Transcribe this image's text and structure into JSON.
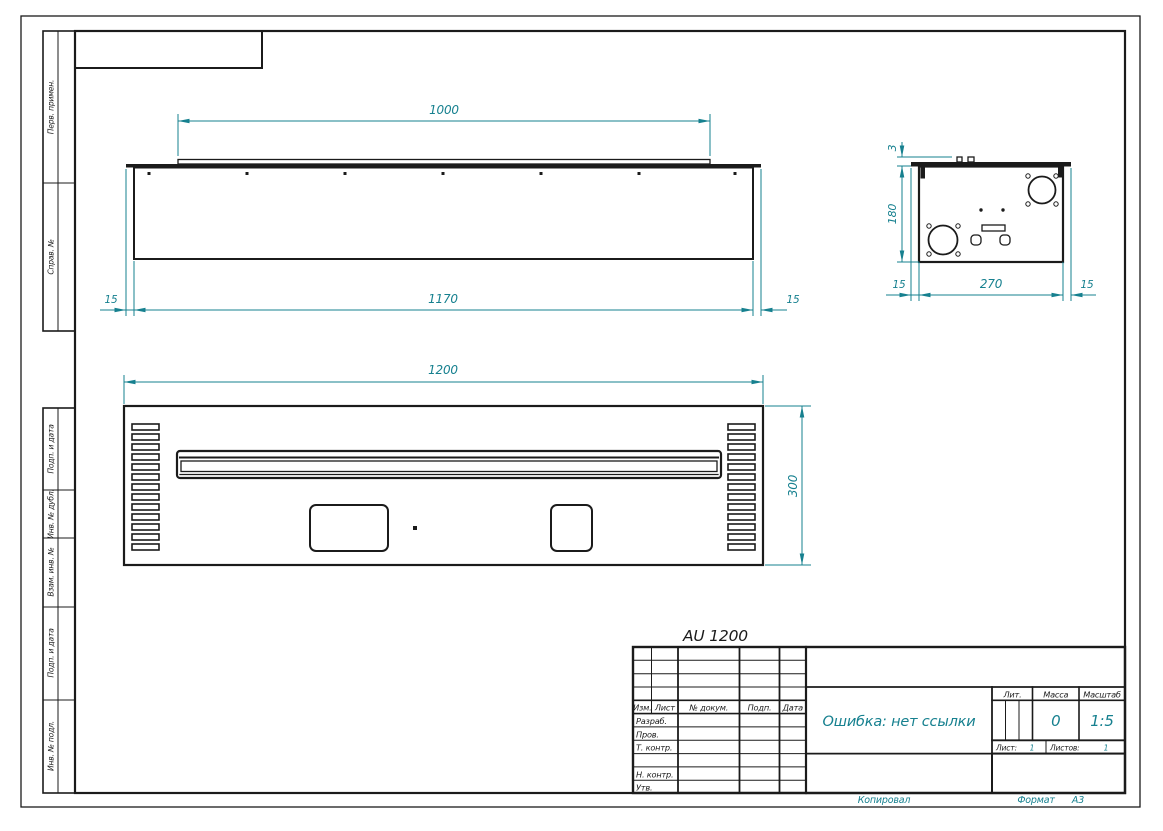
{
  "accent_color": "#16808f",
  "line_color": "#1b1b1b",
  "drawing_label": "AU 1200",
  "margin": {
    "perv_primen": "Перв. примен.",
    "sprav_no": "Справ. №",
    "podp_i_data_1": "Подп. и дата",
    "inv_no_dubl": "Инв. № дубл.",
    "vzam_inv_no": "Взам. инв. №",
    "podp_i_data_2": "Подп. и дата",
    "inv_no_podl": "Инв. № подл."
  },
  "dims": {
    "top_view": {
      "strip": "1000",
      "body": "1170",
      "left": "15",
      "right": "15"
    },
    "front_view": {
      "width": "1200",
      "height": "300"
    },
    "side_view": {
      "flange": "3",
      "height": "180",
      "left": "15",
      "depth": "270",
      "right": "15"
    }
  },
  "title_block": {
    "col_izm": "Изм.",
    "col_list": "Лист",
    "col_doc": "№ докум.",
    "col_podp": "Подп.",
    "col_data": "Дата",
    "row_razrab": "Разраб.",
    "row_prov": "Пров.",
    "row_tcontr": "Т. контр.",
    "row_ncontr": "Н. контр.",
    "row_utv": "Утв.",
    "doc_name": "Ошибка: нет ссылки",
    "lit_label": "Лит.",
    "mass_label": "Масса",
    "scale_label": "Масштаб",
    "mass_value": "0",
    "scale_value": "1:5",
    "sheet_label": "Лист:",
    "sheet_value": "1",
    "sheets_label": "Листов:",
    "sheets_value": "1"
  },
  "footer": {
    "copied": "Копировал",
    "format_label": "Формат",
    "format_value": "А3"
  }
}
